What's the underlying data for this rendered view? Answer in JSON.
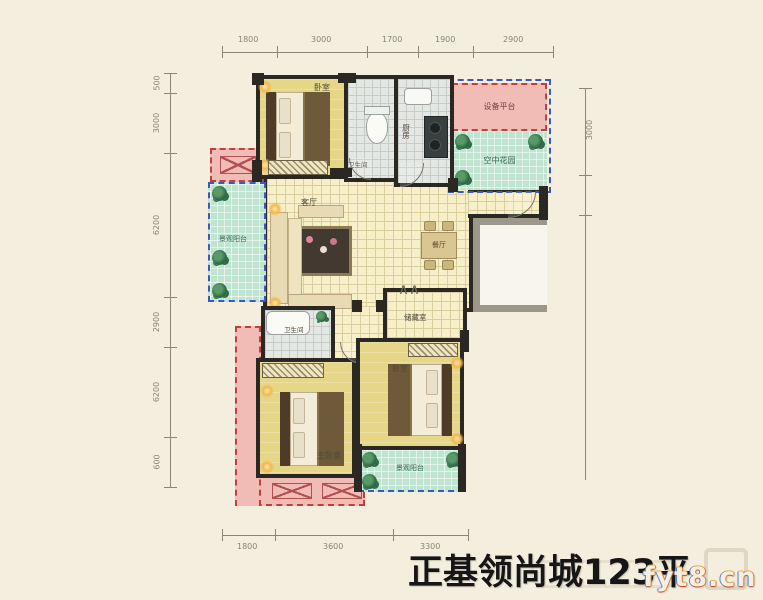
{
  "title": "正基领尚城123平",
  "watermark": "fyt8.cn",
  "dims": {
    "top": [
      "1800",
      "3000",
      "1700",
      "1900",
      "2900"
    ],
    "left": [
      "500",
      "3000",
      "6200",
      "2900",
      "6200",
      "600"
    ],
    "right": [
      "3000"
    ],
    "bottom": [
      "1800",
      "3600",
      "3300"
    ]
  },
  "rooms": {
    "bedroom_top": "卧室",
    "bathroom_top": "卫生间",
    "kitchen": "厨房",
    "equipment_platform": "设备平台",
    "sky_garden": "空中花园",
    "balcony_left": "景观阳台",
    "living_room": "客厅",
    "dining_room": "餐厅",
    "storage": "储藏室",
    "bathroom_mid": "卫生间",
    "master_bedroom": "主卧室",
    "bedroom_bottom": "卧室",
    "balcony_bottom": "景观阳台"
  },
  "colors": {
    "wall": "#2b2823",
    "bedroom_floor": "#e5d688",
    "tile_floor": "#f6efc8",
    "wet_floor": "#e4e7e3",
    "balcony_green": "#bfe5d0",
    "platform_pink": "#f1bcb6",
    "dash_red": "#c04040",
    "dash_blue": "#3b57c0",
    "background": "#f4eedf"
  }
}
